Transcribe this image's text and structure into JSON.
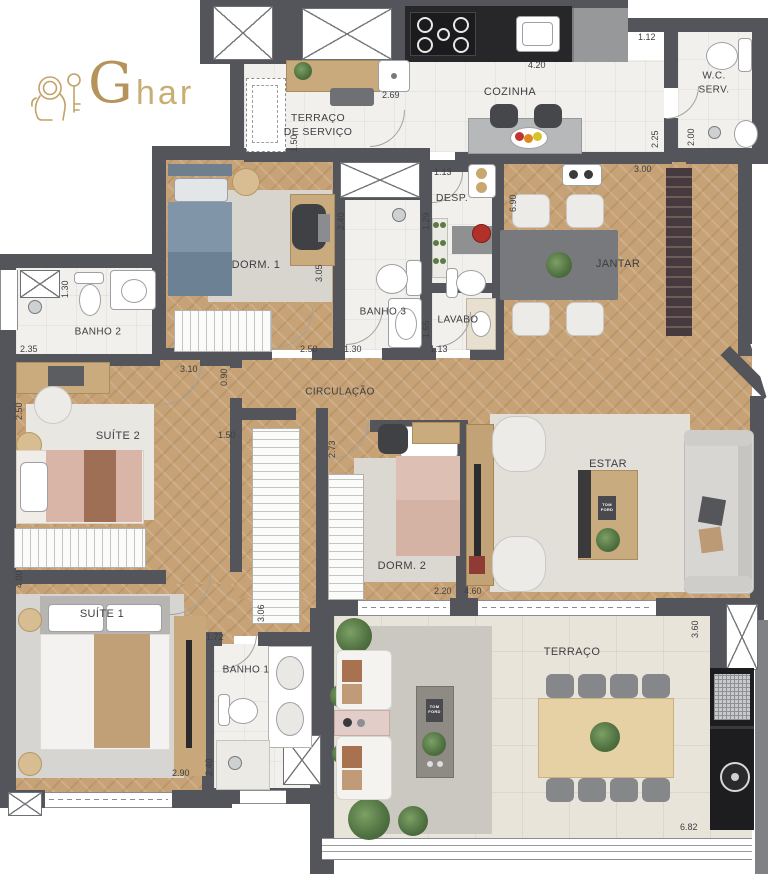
{
  "brand": {
    "g": "G",
    "rest": "har"
  },
  "palette": {
    "wall": "#54555a",
    "wood": "#c6a276",
    "tile": "#f1f0ed",
    "terrace_tile": "#e9e4d9",
    "gold": "#b6935a",
    "counter_black": "#27272a"
  },
  "rooms": {
    "terraco_servico": {
      "line1": "TERRAÇO",
      "line2": "DE SERVIÇO"
    },
    "cozinha": {
      "label": "COZINHA"
    },
    "wc_serv": {
      "line1": "W.C.",
      "line2": "SERV."
    },
    "desp": {
      "label": "DESP."
    },
    "jantar": {
      "label": "JANTAR"
    },
    "dorm1": {
      "label": "DORM. 1"
    },
    "banho3": {
      "label": "BANHO 3"
    },
    "lavabo": {
      "label": "LAVABO"
    },
    "banho2": {
      "label": "BANHO 2"
    },
    "circulacao": {
      "label": "CIRCULAÇÃO"
    },
    "suite2": {
      "label": "SUÍTE 2"
    },
    "estar": {
      "label": "ESTAR"
    },
    "dorm2": {
      "label": "DORM. 2"
    },
    "suite1": {
      "label": "SUÍTE 1"
    },
    "banho1": {
      "label": "BANHO 1"
    },
    "terraco": {
      "label": "TERRAÇO"
    }
  },
  "dims": [
    {
      "id": "cozinha-top",
      "v": "4.20"
    },
    {
      "id": "wc-serv-width",
      "v": "1.12"
    },
    {
      "id": "wc-serv-depth",
      "v": "2.00"
    },
    {
      "id": "kitchen-passage",
      "v": "2.25"
    },
    {
      "id": "jantar-top",
      "v": "3.00"
    },
    {
      "id": "terraco-servico-width",
      "v": "2.69"
    },
    {
      "id": "terraco-servico-depth",
      "v": "1.50"
    },
    {
      "id": "desp-width",
      "v": "1.13"
    },
    {
      "id": "desp-depth",
      "v": "1.29"
    },
    {
      "id": "jantar-depth",
      "v": "6.90"
    },
    {
      "id": "banho3-depth",
      "v": "2.40"
    },
    {
      "id": "lavabo-depth",
      "v": "1.65"
    },
    {
      "id": "lavabo-width",
      "v": "1.13"
    },
    {
      "id": "banho3-width",
      "v": "1.30"
    },
    {
      "id": "dorm1-width",
      "v": "2.50"
    },
    {
      "id": "dorm1-depth",
      "v": "3.05"
    },
    {
      "id": "banho2-depth",
      "v": "1.30"
    },
    {
      "id": "banho2-width",
      "v": "2.35"
    },
    {
      "id": "circulacao-width",
      "v": "3.10"
    },
    {
      "id": "circulacao-depth",
      "v": "0.90"
    },
    {
      "id": "suite2-depth",
      "v": "2.50"
    },
    {
      "id": "closet-niche",
      "v": "1.50"
    },
    {
      "id": "dorm2-depth",
      "v": "2.73"
    },
    {
      "id": "suite1-depth",
      "v": "4.00"
    },
    {
      "id": "corridor-closet",
      "v": "3.06"
    },
    {
      "id": "dorm2-width",
      "v": "2.20"
    },
    {
      "id": "estar-width",
      "v": "4.60"
    },
    {
      "id": "banho1-width",
      "v": "1.72"
    },
    {
      "id": "banho1-depth",
      "v": "2.40"
    },
    {
      "id": "suite1-width",
      "v": "2.90"
    },
    {
      "id": "terraco-depth",
      "v": "3.60"
    },
    {
      "id": "terraco-width",
      "v": "6.82"
    }
  ],
  "decor": {
    "book": "TOM FORD"
  }
}
